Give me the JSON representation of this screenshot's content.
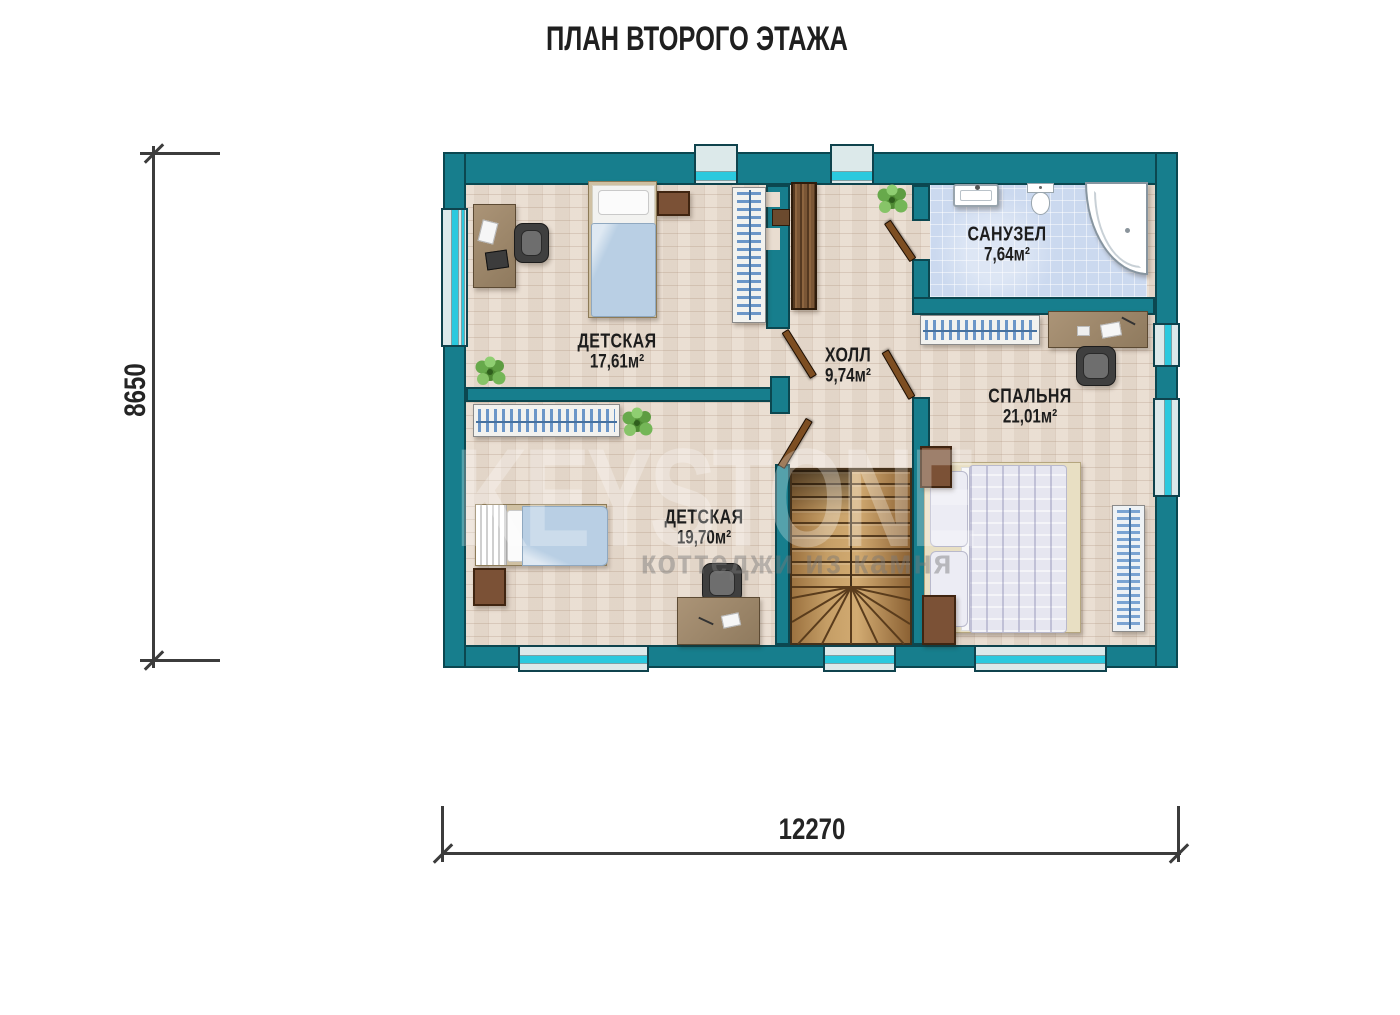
{
  "title": "ПЛАН ВТОРОГО ЭТАЖА",
  "watermark": {
    "brand": "KEYSTONE",
    "tagline": "коттеджи из камня"
  },
  "dimensions": {
    "height_mm": "8650",
    "width_mm": "12270"
  },
  "rooms": {
    "nursery1": {
      "name": "ДЕТСКАЯ",
      "area": "17,61м²"
    },
    "nursery2": {
      "name": "ДЕТСКАЯ",
      "area": "19,70м²"
    },
    "hall": {
      "name": "ХОЛЛ",
      "area": "9,74м²"
    },
    "bathroom": {
      "name": "САНУЗЕЛ",
      "area": "7,64м²"
    },
    "bedroom": {
      "name": "СПАЛЬНЯ",
      "area": "21,01м²"
    }
  },
  "colors": {
    "wall": "#177e8d",
    "wallOutline": "#0b4750",
    "glass": "#2bc9de",
    "windowPanel": "#dce9ea",
    "floor": "#e9ddd0",
    "tile": "#cbd9ef",
    "hanger": "#6b96c8",
    "doorLeaf": "#7d4e22",
    "stairWood": "#c09a63",
    "dimLine": "#3c3c3c"
  }
}
